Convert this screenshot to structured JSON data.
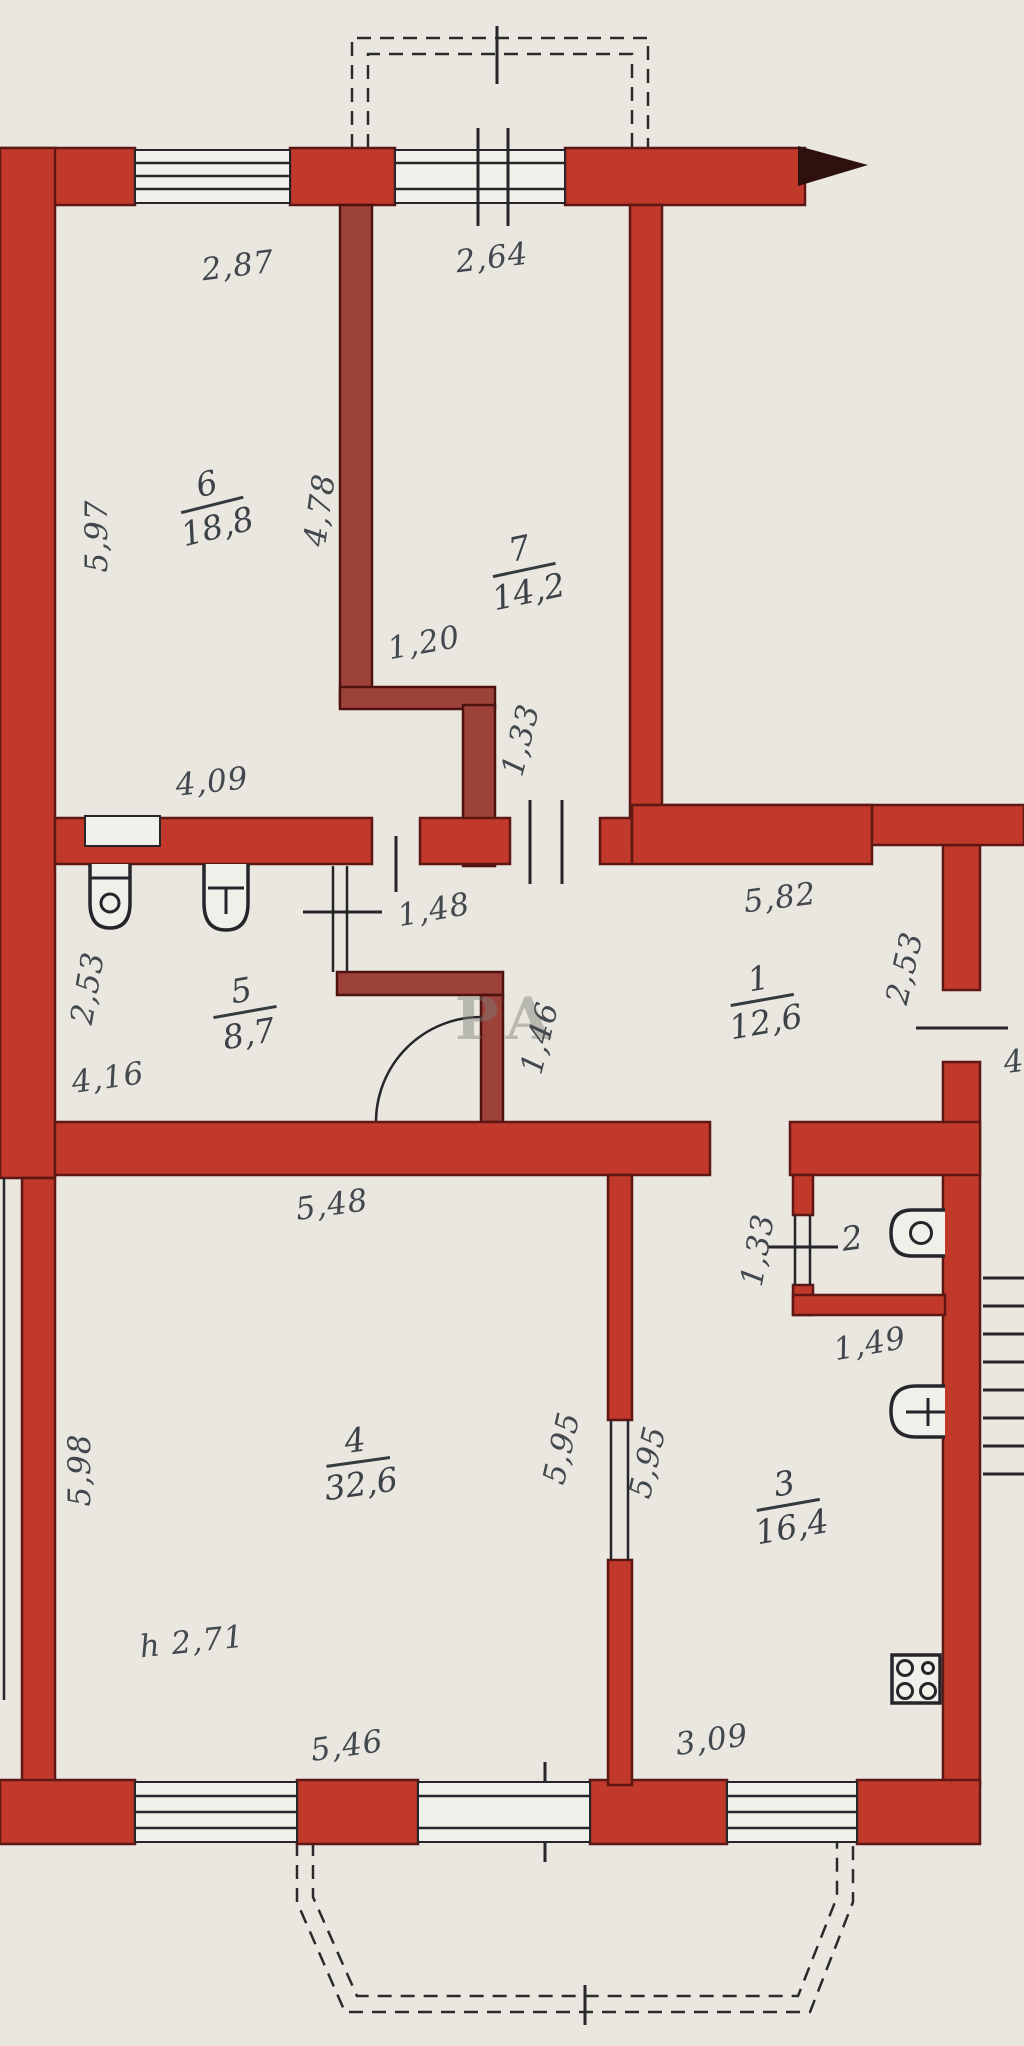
{
  "title": "apartment floor plan",
  "watermark": "РА",
  "colors": {
    "paper": "#e9e7e0",
    "wall_fill": "#c0392b",
    "wall_fill_dark": "#9c423a",
    "wall_edge": "#5e1713",
    "line": "#26262a",
    "text": "#42484d"
  },
  "rooms": {
    "r6": {
      "number": "6",
      "area": "18,8"
    },
    "r7": {
      "number": "7",
      "area": "14,2"
    },
    "r5": {
      "number": "5",
      "area": "8,7"
    },
    "r1": {
      "number": "1",
      "area": "12,6"
    },
    "r4": {
      "number": "4",
      "area": "32,6"
    },
    "r3": {
      "number": "3",
      "area": "16,4"
    },
    "r2": {
      "number": "2",
      "area": ""
    }
  },
  "dims": {
    "top_left": "2,87",
    "top_mid": "2,64",
    "left_upper": "5,97",
    "wall67": "4,78",
    "jog_w": "1,20",
    "jog_h": "1,33",
    "room6_bottom": "4,09",
    "room5_doorway": "1,48",
    "room5_left": "2,53",
    "room5_bottom": "4,16",
    "room1_top": "5,82",
    "room1_right": "2,53",
    "corridor": "1,46",
    "room4_top": "5,48",
    "wc_left": "1,33",
    "wc_bottom": "1,49",
    "room4_left": "5,98",
    "room4_right": "5,95",
    "room3_left": "5,95",
    "height": "h 2,71",
    "room4_bottom": "5,46",
    "room3_bottom": "3,09",
    "landing": "4"
  },
  "icons": {
    "room5_fixture_left": "basin-with-drain-icon",
    "room5_fixture_right": "washbasin-tap-icon",
    "wc_fixture": "toilet-icon",
    "room3_fixture": "washbasin-tap-icon",
    "room3_stove": "stove-burners-icon",
    "stairs": "stairs-icon",
    "entrance": "arrow-icon"
  }
}
